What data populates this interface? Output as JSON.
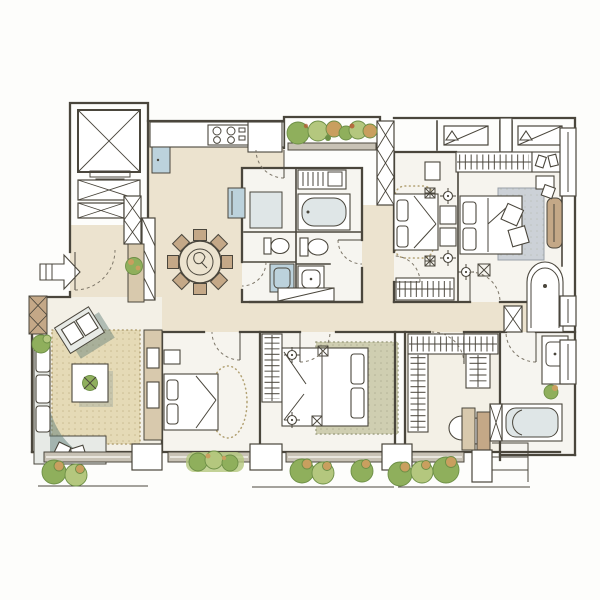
{
  "meta": {
    "title": "Hand-drawn watercolor apartment floor plan, four bedrooms with two baths, walk-in closet and balconies",
    "style": "hand-drawn watercolor architectural plan",
    "orientation_note": "entry arrow on left edge points right into the unit"
  },
  "palette": {
    "ink": "#4a463c",
    "inkSoft": "#7d7668",
    "wallGray": "#c8c2b5",
    "floorWarm": "#ece3cf",
    "floorLight": "#f3f0e6",
    "floorPale": "#f6f4ee",
    "bathFloor": "#f6f5f0",
    "rugBeige": "#e5dab6",
    "rugSage": "#cfceb1",
    "rugGray": "#ccd1d7",
    "stippleBeige": "#b2a173",
    "stippleSage": "#9fa083",
    "wood": "#c4a887",
    "woodLight": "#d8c9ad",
    "plantGreen": "#8faf5c",
    "plantDeep": "#6d8f46",
    "plantLight": "#b4c77e",
    "plantTan": "#c99f5f",
    "fixtureBlue": "#bcd2dc",
    "tubGray": "#dfe6e7",
    "sofaGray": "#e7eae6",
    "tealShadow": "#5f7d78",
    "paper": "#fdfdfb"
  },
  "rooms": [
    {
      "name": "entry-foyer",
      "fixtures": [
        "entry-arrow",
        "entry-door",
        "shoe-cabinet",
        "plant"
      ]
    },
    {
      "name": "elevator-and-service-core",
      "fixtures": [
        "elevator-shaft",
        "stair-shaft",
        "duct-shaft",
        "duct-shaft"
      ]
    },
    {
      "name": "kitchen",
      "fixtures": [
        "counter",
        "cooktop-4-burner",
        "tall-cabinet",
        "refrigerator",
        "appliance-cabinet",
        "balcony-door"
      ]
    },
    {
      "name": "dining-room",
      "fixtures": [
        "round-dining-table",
        "lazy-susan",
        "dining-chairs-x8",
        "lattice-screen"
      ]
    },
    {
      "name": "main-bathroom",
      "fixtures": [
        "vanity-shelf",
        "bathtub",
        "toilet",
        "basin",
        "mirror-shower-cabinet",
        "second-toilet",
        "washing-machine",
        "storage-cabinet"
      ]
    },
    {
      "name": "bedroom-north",
      "fixtures": [
        "bed",
        "pillows",
        "dotted-rug",
        "nightstands",
        "ceiling-lamps",
        "dresser",
        "wardrobe"
      ]
    },
    {
      "name": "master-bedroom",
      "fixtures": [
        "double-bed",
        "pillows",
        "gray-rug",
        "cushions",
        "hanging-closet",
        "shoe-shelf",
        "dresser",
        "desk-chair",
        "window",
        "ceiling-lamp"
      ]
    },
    {
      "name": "bedroom-west",
      "fixtures": [
        "bed",
        "pillow",
        "oval-dotted-rug",
        "nightstand",
        "tv-console"
      ]
    },
    {
      "name": "bedroom-center",
      "fixtures": [
        "double-bed",
        "pillows",
        "sage-rug",
        "wardrobe",
        "ceiling-lamps"
      ]
    },
    {
      "name": "walk-in-closet",
      "fixtures": [
        "wardrobe-run-top",
        "wardrobe-run-left",
        "wardrobe-island",
        "vanity-panel",
        "dressing-stool"
      ]
    },
    {
      "name": "master-bathroom",
      "fixtures": [
        "shower",
        "vanity-basin",
        "plant",
        "toilet",
        "bathtub",
        "duct-shaft",
        "windows"
      ]
    },
    {
      "name": "living-room",
      "fixtures": [
        "l-shaped-sofa",
        "throw-pillows",
        "armchair",
        "coffee-table",
        "plant",
        "beige-rug",
        "corner-plant",
        "pier-with-cross-bracing"
      ]
    },
    {
      "name": "corridor",
      "fixtures": []
    },
    {
      "name": "balcony-north",
      "fixtures": [
        "planting",
        "ac-unit",
        "ac-unit"
      ]
    },
    {
      "name": "balcony-south",
      "fixtures": [
        "planter-box",
        "shrubs-x8",
        "parapet",
        "steps"
      ]
    }
  ],
  "counts": {
    "dining_chairs": 8,
    "south_shrubs": 8,
    "ac_units": 2,
    "beds": 4,
    "bathtubs": 2,
    "toilets": 3
  }
}
